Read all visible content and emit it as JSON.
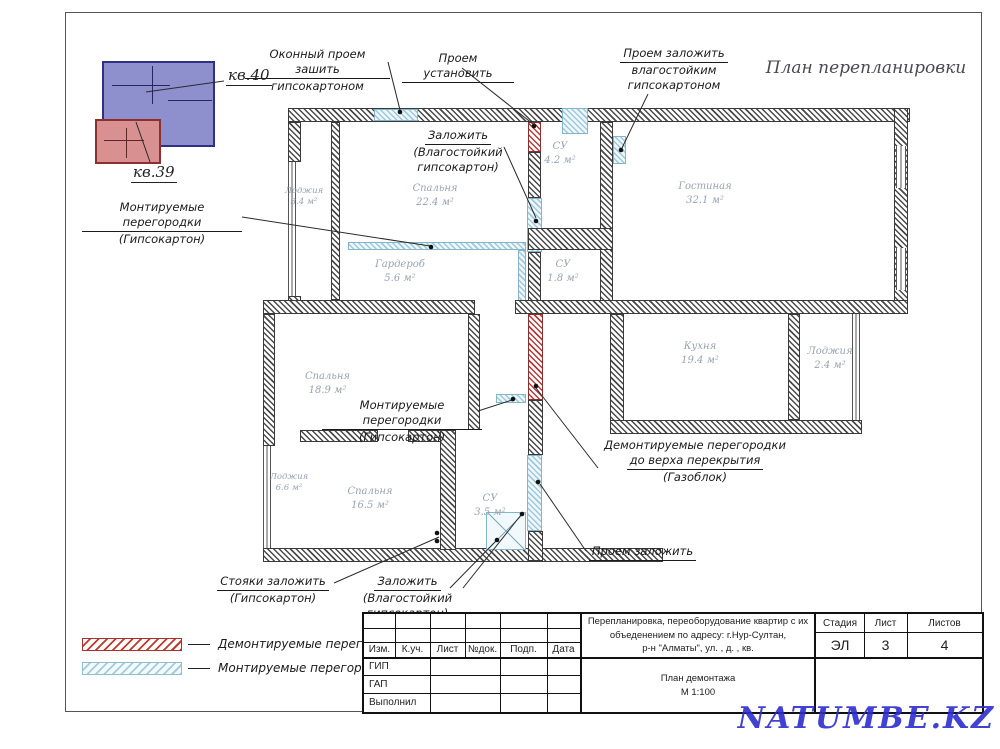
{
  "sheet": {
    "title": "План перепланировки",
    "watermark": "NATUMBE.KZ"
  },
  "inset": {
    "apt_top_label": "кв.40",
    "apt_bottom_label": "кв.39"
  },
  "annotations": {
    "window_close": {
      "l1": "Оконный проем зашить",
      "l2": "гипсокартоном"
    },
    "opening_install": {
      "l1": "Проем установить"
    },
    "opening_close_wet": {
      "l1": "Проем заложить",
      "l2": "влагостойким",
      "l3": "гипсокартоном"
    },
    "close_wet_upper": {
      "l1": "Заложить",
      "l2": "(Влагостойкий",
      "l3": "гипсокартон)"
    },
    "mount_left": {
      "l1": "Монтируемые перегородки",
      "l2": "(Гипсокартон)"
    },
    "mount_mid": {
      "l1": "Монтируемые перегородки",
      "l2": "(Гипсокартон)"
    },
    "demount_gas": {
      "l1": "Демонтируемые перегородки",
      "l2": "до верха перекрытия",
      "l3": "(Газоблок)"
    },
    "opening_close": {
      "l1": "Проем заложить"
    },
    "risers_close": {
      "l1": "Стояки заложить",
      "l2": "(Гипсокартон)"
    },
    "close_wet_lower": {
      "l1": "Заложить",
      "l2": "(Влагостойкий гипсокартон)"
    }
  },
  "rooms": [
    {
      "name": "Лоджия",
      "area": "3.4 м²"
    },
    {
      "name": "Спальня",
      "area": "22.4 м²"
    },
    {
      "name": "Гардероб",
      "area": "5.6 м²"
    },
    {
      "name": "СУ",
      "area": "4.2 м²"
    },
    {
      "name": "СУ",
      "area": "1.8 м²"
    },
    {
      "name": "Гостиная",
      "area": "32.1 м²"
    },
    {
      "name": "Спальня",
      "area": "18.9 м²"
    },
    {
      "name": "Кухня",
      "area": "19.4 м²"
    },
    {
      "name": "Лоджия",
      "area": "2.4 м²"
    },
    {
      "name": "Лоджия",
      "area": "6.6 м²"
    },
    {
      "name": "Спальня",
      "area": "16.5 м²"
    },
    {
      "name": "СУ",
      "area": "3.5 м²"
    }
  ],
  "legend": [
    {
      "label": "Демонтируемые перегородки"
    },
    {
      "label": "Монтируемые перегородки"
    }
  ],
  "titleblock": {
    "project_l1": "Перепланировка, переоборудование квартир с их",
    "project_l2": "объеденением по адресу: г.Нур-Султан,",
    "project_l3": "р-н \"Алматы\", ул.        , д.     , кв.",
    "stage_label": "Стадия",
    "stage_value": "ЭЛ",
    "sheet_label": "Лист",
    "sheet_value": "3",
    "sheets_label": "Листов",
    "sheets_value": "4",
    "col_izm": "Изм.",
    "col_kuch": "К.уч.",
    "col_list": "Лист",
    "col_ndok": "№док.",
    "col_podp": "Подп.",
    "col_data": "Дата",
    "role_gip": "ГИП",
    "role_gap": "ГАП",
    "role_exec": "Выполнил",
    "doc_title": "План демонтажа",
    "scale": "М 1:100"
  },
  "colors": {
    "demolish": "#b23b3b",
    "mount": "#9fc8da",
    "inset_top": "#8d90cc",
    "inset_bottom": "#d99090",
    "watermark": "#2d2dd0"
  }
}
